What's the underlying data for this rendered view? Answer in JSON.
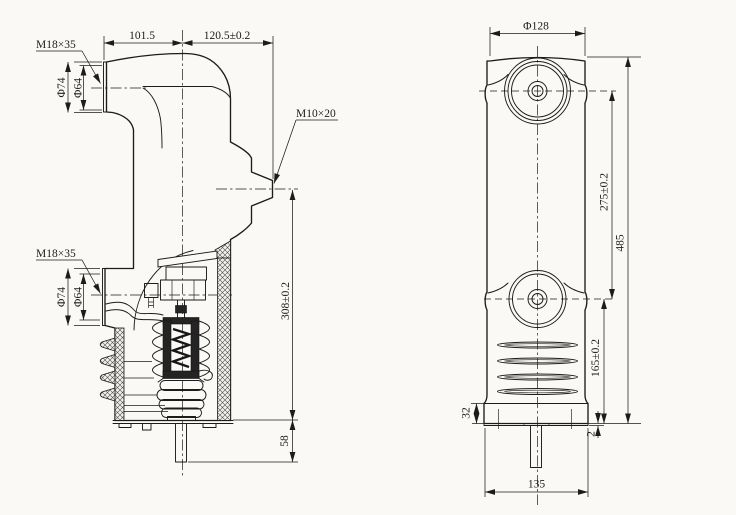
{
  "page": {
    "background": "#faf9f6",
    "ink": "#1c1c1c"
  },
  "side_view": {
    "callouts": {
      "upper_thread": "M18×35",
      "lower_thread": "M18×35",
      "side_thread": "M10×20"
    },
    "dims": {
      "arm_left": "101.5",
      "arm_right": "120.5±0.2",
      "upper_outer_dia": "Φ74",
      "upper_inner_dia": "Φ64",
      "lower_outer_dia": "Φ74",
      "lower_inner_dia": "Φ64",
      "body_height": "308±0.2",
      "rod_length": "58"
    }
  },
  "front_view": {
    "dims": {
      "top_dia": "Φ128",
      "terminal_spacing": "275±0.2",
      "overall_height": "485",
      "lower_terminal_height": "165±0.2",
      "base_height": "32",
      "plate_thickness": "2",
      "base_width": "135"
    }
  }
}
